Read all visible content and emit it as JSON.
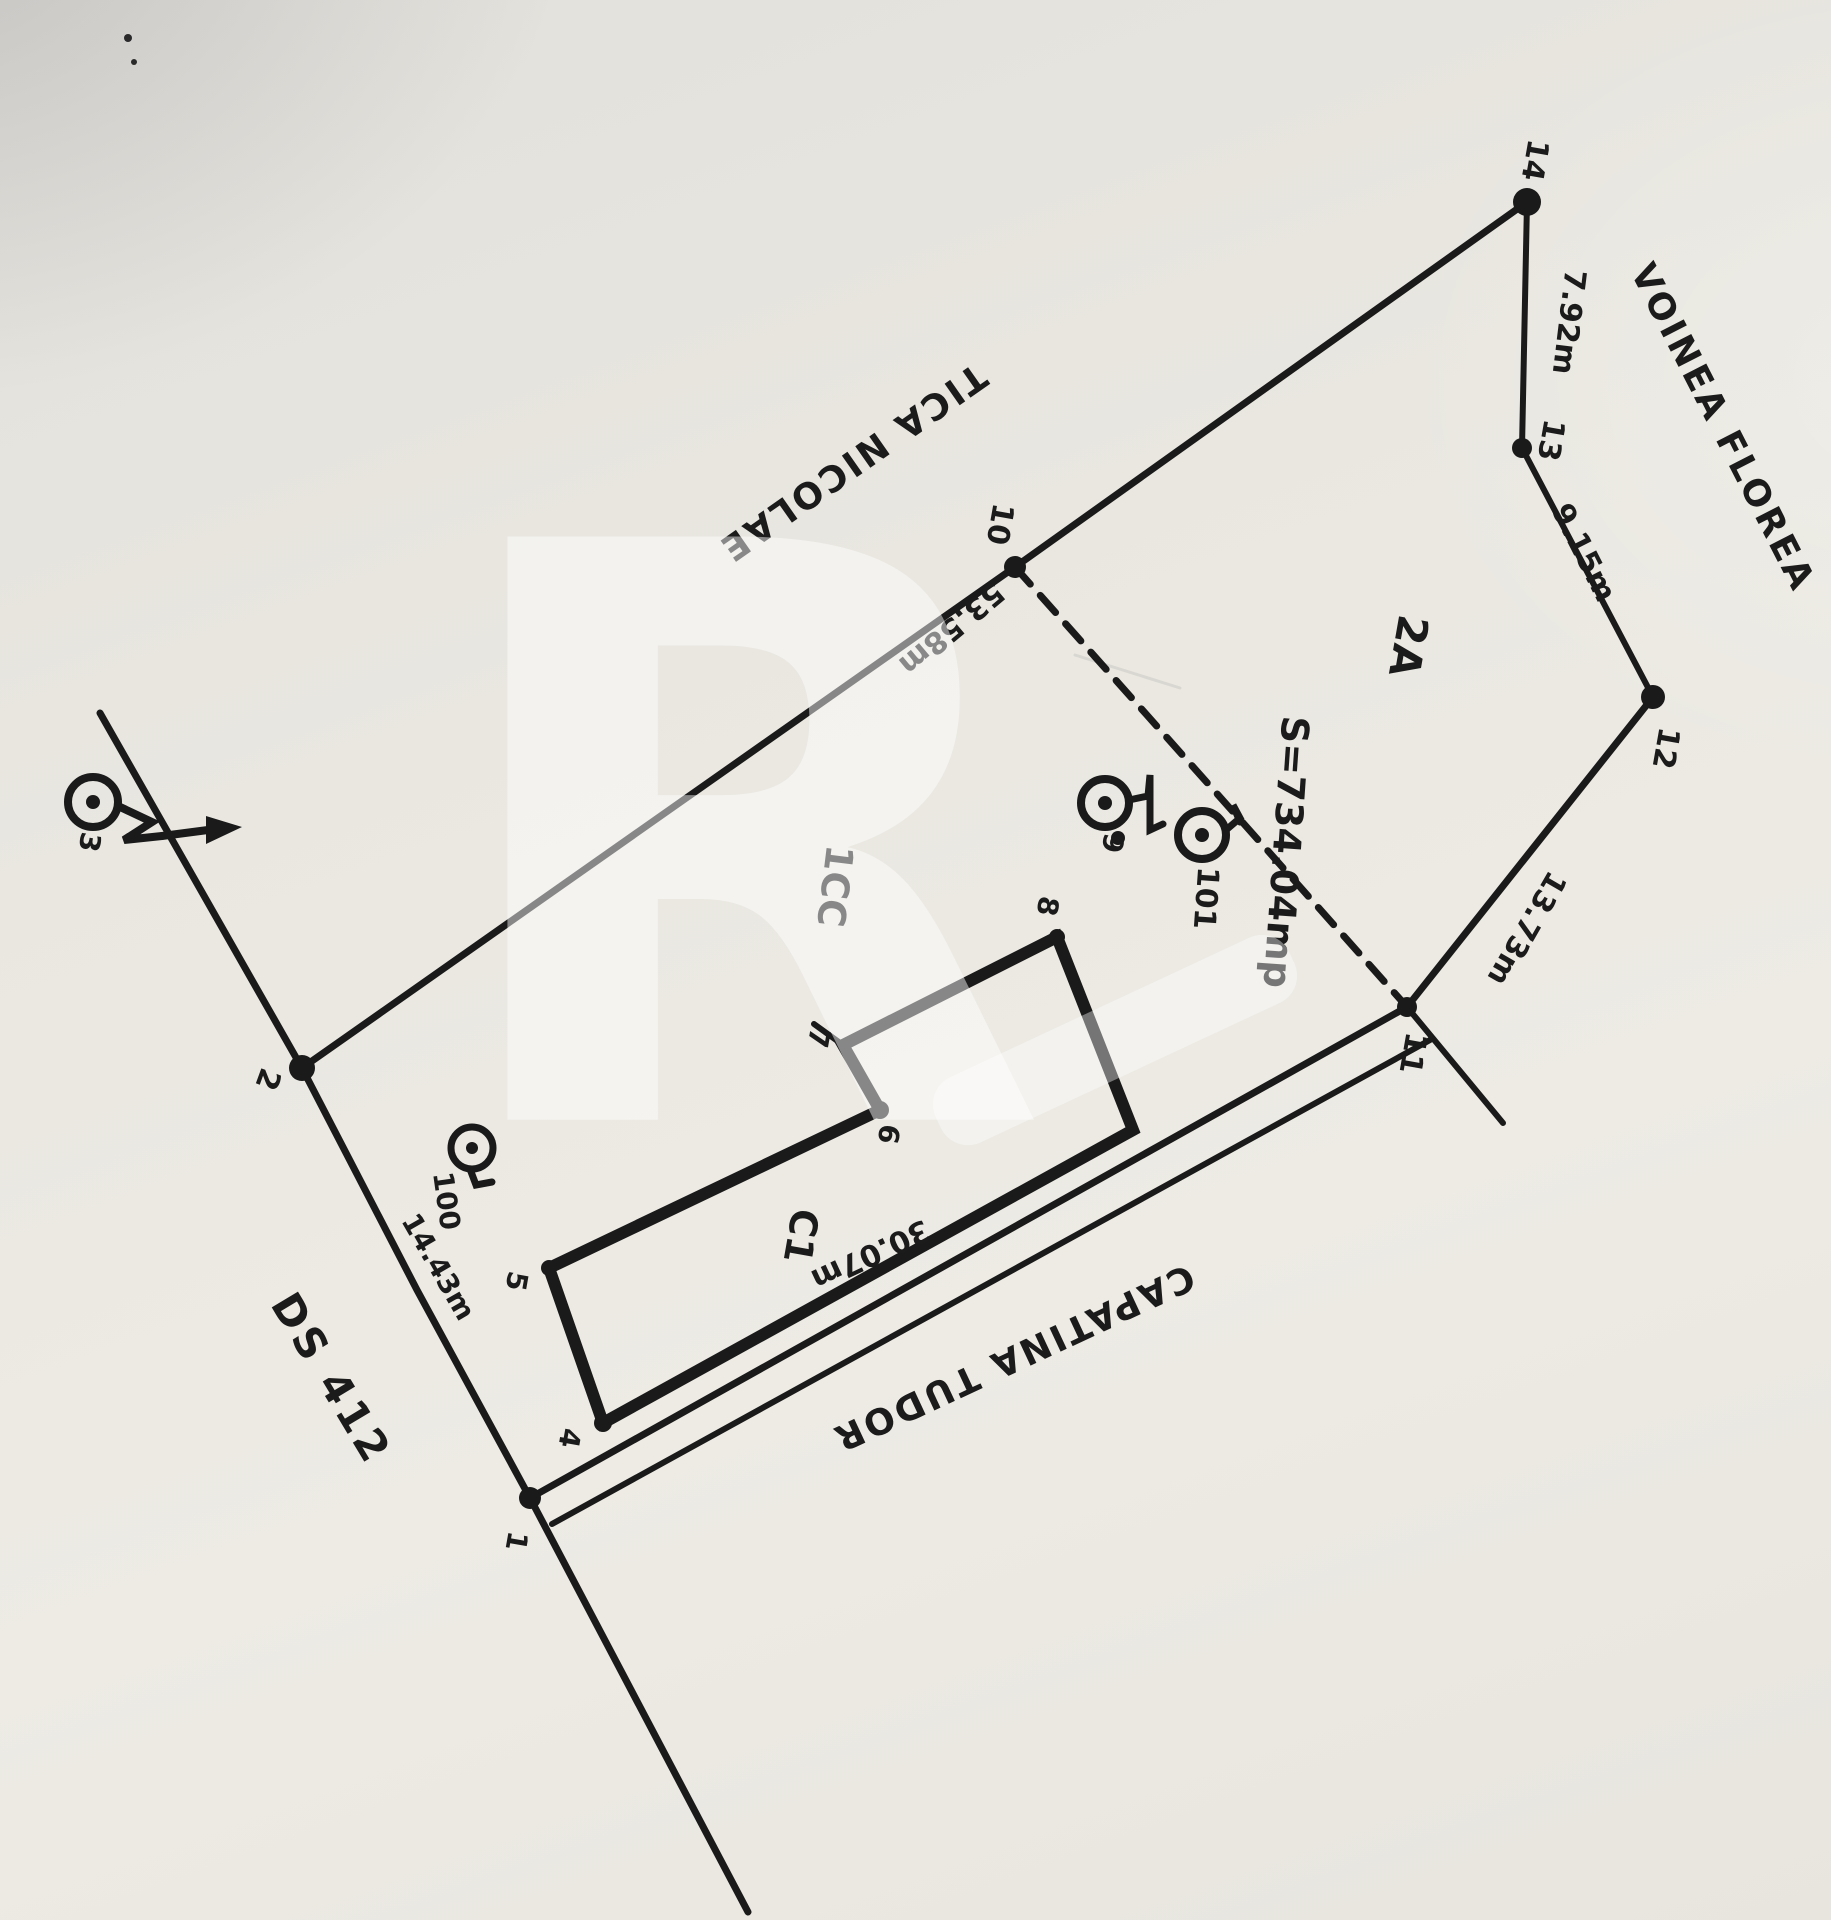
{
  "plan": {
    "points": {
      "p1": "1",
      "p2": "2",
      "p3": "3",
      "p4": "4",
      "p5": "5",
      "p6": "6",
      "p7": "7",
      "p8": "8",
      "p9": "9",
      "p10": "10",
      "p11": "11",
      "p12": "12",
      "p13": "13",
      "p14": "14",
      "p100": "100",
      "p101": "101"
    },
    "dimensions": {
      "d14_13": "7.92m",
      "d13_12": "9.15m",
      "d12_11": "13.73m",
      "d10_2": "53.58m",
      "d2_1": "14.43m",
      "d11_1": "30.07m"
    },
    "area": "S=734.04mp",
    "parcels": {
      "lot": "2A",
      "courtyard": "1CC",
      "building": "C1"
    },
    "neighbors": {
      "north_east": "VOINEA FLOREA",
      "north_west": "TICA NICOLAE",
      "south": "CAPATINA TUDOR"
    },
    "road": "DS 412",
    "watermark": "R",
    "ink_color": "#1a1a1a",
    "paper_color": "#e9e7e0"
  }
}
